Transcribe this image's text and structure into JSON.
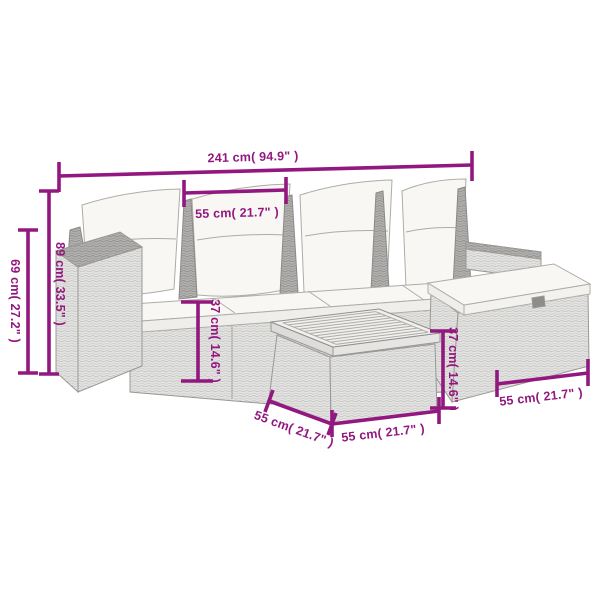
{
  "theme": {
    "accent": "#92187F",
    "background": "#FFFFFF",
    "wicker_light": "#E4E4E3",
    "wicker_dark": "#B5B4B2",
    "cushion": "#F8F7F3"
  },
  "dims": [
    {
      "id": "overall-width",
      "label": "241 cm( 94.9\" )"
    },
    {
      "id": "seat-width",
      "label": "55 cm( 21.7\" )"
    },
    {
      "id": "total-height",
      "label": "69 cm( 27.2\" )"
    },
    {
      "id": "back-height",
      "label": "89 cm( 33.5\" )"
    },
    {
      "id": "seat-base-height",
      "label": "37 cm( 14.6\" )"
    },
    {
      "id": "ottoman-height",
      "label": "37 cm( 14.6\" )"
    },
    {
      "id": "ottoman-width",
      "label": "55 cm( 21.7\" )"
    },
    {
      "id": "table-width",
      "label": "55 cm( 21.7\" )"
    },
    {
      "id": "table-depth",
      "label": "55 cm( 21.7\" )"
    }
  ]
}
